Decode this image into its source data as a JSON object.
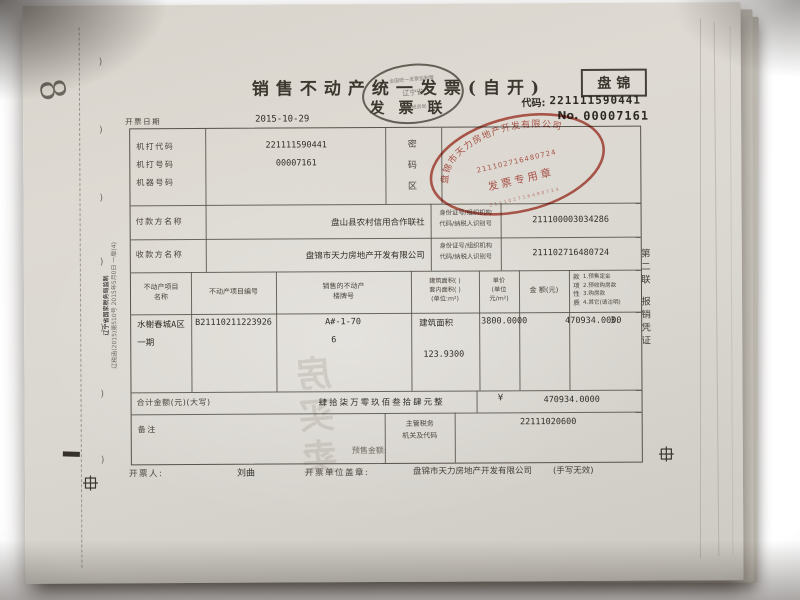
{
  "invoice": {
    "title": "销售不动产统一发票(自开)",
    "region": "盘锦",
    "copy_name": "发票联",
    "code_label": "代码:",
    "code_value": "221111590441",
    "no_label": "No.",
    "no_value": "00007161",
    "date_label": "开票日期",
    "date_value": "2015-10-29",
    "machine": {
      "rows": [
        {
          "label": "机打代码",
          "value": "221111590441"
        },
        {
          "label": "机打号码",
          "value": "00007161"
        },
        {
          "label": "机器号码",
          "value": ""
        }
      ],
      "password_zone": "密码区"
    },
    "payer": {
      "label": "付款方名称",
      "name": "盘山县农村信用合作联社",
      "id_label_1": "身份证号/组织机构",
      "id_label_2": "代码/纳税人识别号",
      "id_value": "211100003034286"
    },
    "payee": {
      "label": "收款方名称",
      "name": "盘锦市天力房地产开发有限公司",
      "id_label_1": "身份证号/组织机构",
      "id_label_2": "代码/纳税人识别号",
      "id_value": "211102716480724"
    },
    "table": {
      "col_name_1": "不动产项目",
      "col_name_2": "名称",
      "col_code": "不动产项目编号",
      "col_building_1": "销售的不动产",
      "col_building_2": "楼牌号",
      "col_area_1": "建筑面积(  )",
      "col_area_2": "套内面积(  )",
      "col_area_3": "(单位:m²)",
      "col_price_1": "单价",
      "col_price_2": "(单位",
      "col_price_3": "元/m²)",
      "col_amount": "金 额(元)",
      "nature_vertical": "款项性质",
      "nature_1": "1.预售定金",
      "nature_2": "2.预收购房款",
      "nature_3": "3.购房款",
      "nature_4": "4.其它(请注明)"
    },
    "item": {
      "name_1": "水榭春城A区",
      "name_2": "一期",
      "code": "B21110211223926",
      "building_1": "A#-1-70",
      "building_2": "6",
      "area_type": "建筑面积",
      "area": "123.9300",
      "price": "3800.0000",
      "amount": "470934.0000",
      "nature": "3."
    },
    "total": {
      "label": "合计金额(元)(大写)",
      "words": "肆拾柒万零玖佰叁拾肆元整",
      "currency": "¥",
      "amount": "470934.0000"
    },
    "remark": {
      "label": "备注",
      "presale": "预售金额:",
      "tax_label_1": "主管税务",
      "tax_label_2": "机关及代码",
      "tax_code": "22111020600"
    },
    "footer": {
      "issuer_label": "开票人:",
      "issuer_name": "刘曲",
      "seal_label": "开票单位盖章:",
      "seal_name": "盘锦市天力房地产开发有限公司",
      "note": "(手写无效)"
    },
    "copy_line_1": "第二联",
    "copy_line_2": "报销凭证",
    "fine_print_1": "辽宁省国家税务局监制",
    "fine_print_2": "辽税函(2015)第510号 2015年5月0日 一版(4)",
    "handwritten_mark": "8",
    "bleed_text": "房买卖",
    "seals": {
      "company": {
        "name": "盘锦市天力房地产开发有限公司",
        "number": "211102716480724",
        "caption": "发票专用章",
        "color": "#b13a2c"
      },
      "monitor": {
        "top": "全国统一发票监制章",
        "center": "辽宁省",
        "bottom": "国家税务局",
        "color": "#4b453c"
      }
    }
  }
}
